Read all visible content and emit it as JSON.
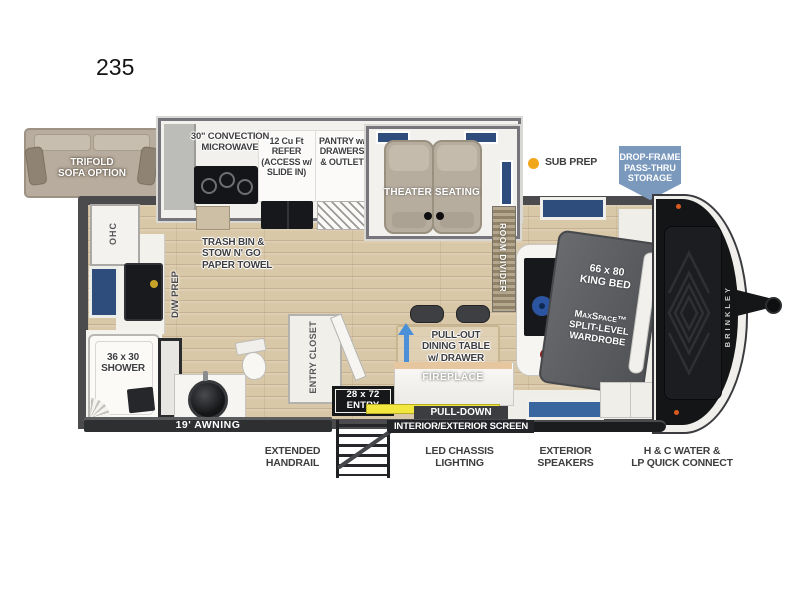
{
  "title": "235",
  "brand": "BRINKLEY",
  "inset": {
    "label": "TRIFOLD\nSOFA OPTION"
  },
  "legend": {
    "sub_prep": "SUB PREP"
  },
  "badge": {
    "label": "DROP-FRAME\nPASS-THRU\nSTORAGE",
    "color": "#7A99BD"
  },
  "rooms": {
    "kitchen": {
      "microwave": "30\" CONVECTION\nMICROWAVE",
      "refrigerator": "12 Cu Ft\nREFER\n(ACCESS w/\nSLIDE IN)",
      "pantry": "PANTRY w/\nDRAWERS\n& OUTLET",
      "trash": "TRASH BIN &\nSTOW N' GO\nPAPER TOWEL",
      "dw_prep": "D/W PREP"
    },
    "living": {
      "theater": "THEATER SEATING",
      "dining": "PULL-OUT\nDINING TABLE\nw/ DRAWER",
      "fireplace": "FIREPLACE",
      "room_divider": "ROOM DIVIDER"
    },
    "bedroom": {
      "bed": "66 x 80\nKING BED",
      "wardrobe": "MaxSpace™\nSPLIT-LEVEL\nWARDROBE"
    },
    "bathroom": {
      "shower": "36 x 30\nSHOWER"
    },
    "entry": {
      "closet": "ENTRY CLOSET",
      "door": "28 x 72\nENTRY",
      "ohc": "OHC"
    }
  },
  "exterior": {
    "awning": "19' AWNING",
    "handrail": "EXTENDED\nHANDRAIL",
    "screen_line1": "PULL-DOWN",
    "screen_line2": "INTERIOR/EXTERIOR SCREEN",
    "chassis_lighting": "LED CHASSIS\nLIGHTING",
    "speakers": "EXTERIOR\nSPEAKERS",
    "water": "H & C WATER &\nLP QUICK CONNECT"
  },
  "colors": {
    "accent_orange": "#F2A71B",
    "badge_blue": "#7A99BD",
    "window_blue": "#2E4D7D",
    "wall_gray": "#4B4B4D",
    "floor_wood": "#D9C8A8",
    "screen_yellow": "#F2E73E",
    "marker_orange": "#D95B1E"
  }
}
